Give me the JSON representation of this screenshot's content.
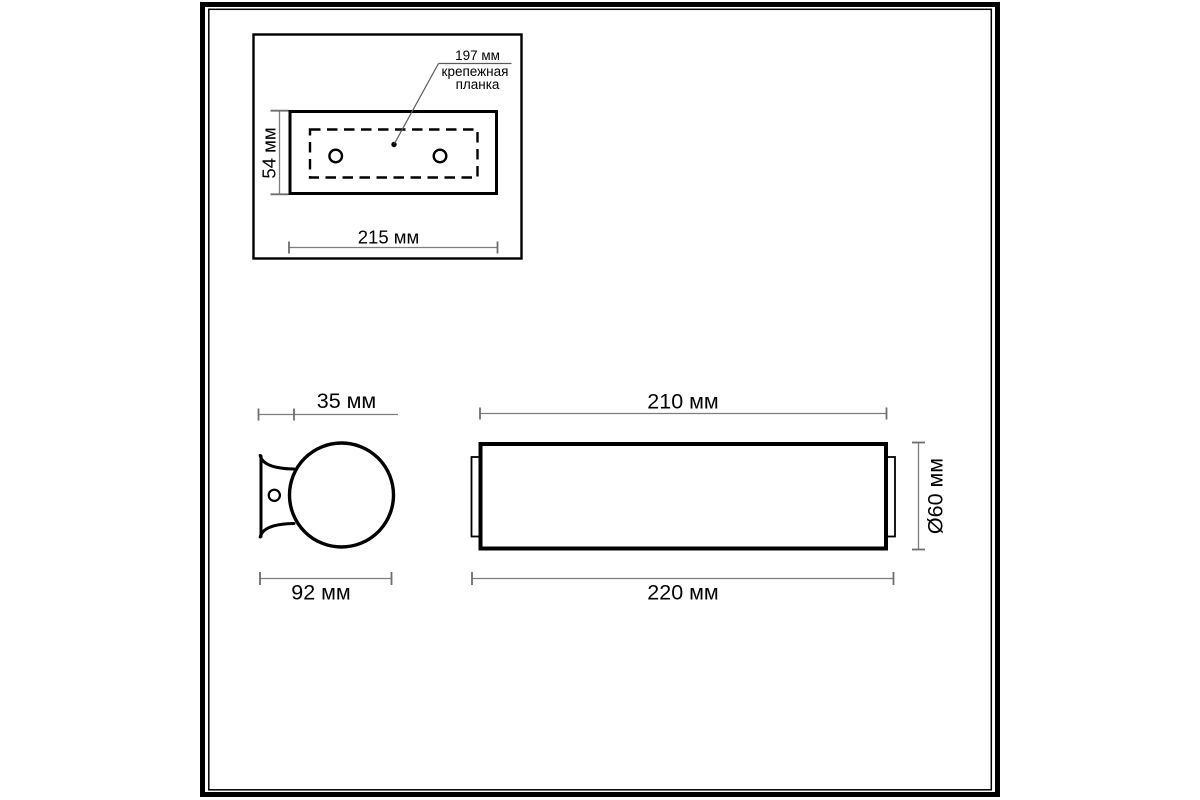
{
  "page": {
    "background": "#ffffff",
    "ink_color": "#000000",
    "dimension_line_color": "#7d7d7d",
    "text_color": "#000000"
  },
  "inset_top_view": {
    "bar_length_label": "197 мм",
    "bar_caption_line1": "крепежная",
    "bar_caption_line2": "планка",
    "plate_height_label": "54 мм",
    "plate_width_label": "215 мм"
  },
  "side_view": {
    "bracket_depth_label": "35 мм",
    "overall_depth_label": "92 мм"
  },
  "front_view": {
    "glass_length_label": "210 мм",
    "diameter_label": "Ø60 мм",
    "overall_length_label": "220 мм"
  }
}
